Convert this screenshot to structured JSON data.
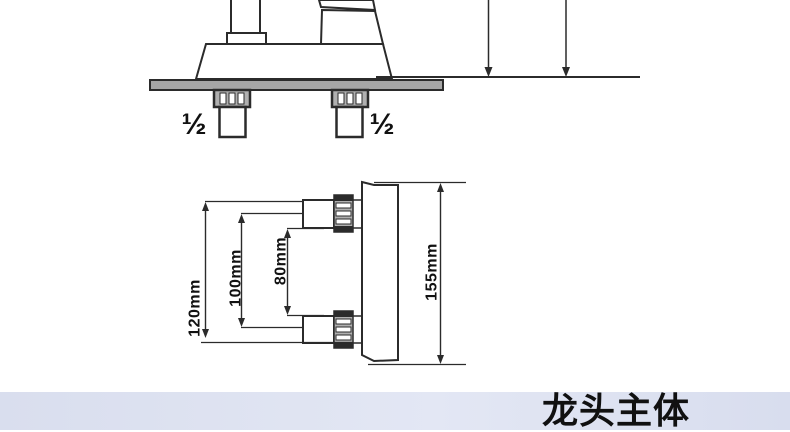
{
  "front_view": {
    "left_inlet_size": "½",
    "right_inlet_size": "½"
  },
  "dimension_view": {
    "outer_span": "120mm",
    "center_span": "100mm",
    "inner_span": "80mm",
    "body_length": "155mm"
  },
  "footer_banner": {
    "title": "龙头主体"
  },
  "colors": {
    "line": "#2b2b2b",
    "deck_fill": "#a6a6a6",
    "nut_fill": "#b0b0b0",
    "banner_bg": "#dde2f0",
    "text": "#111111"
  }
}
